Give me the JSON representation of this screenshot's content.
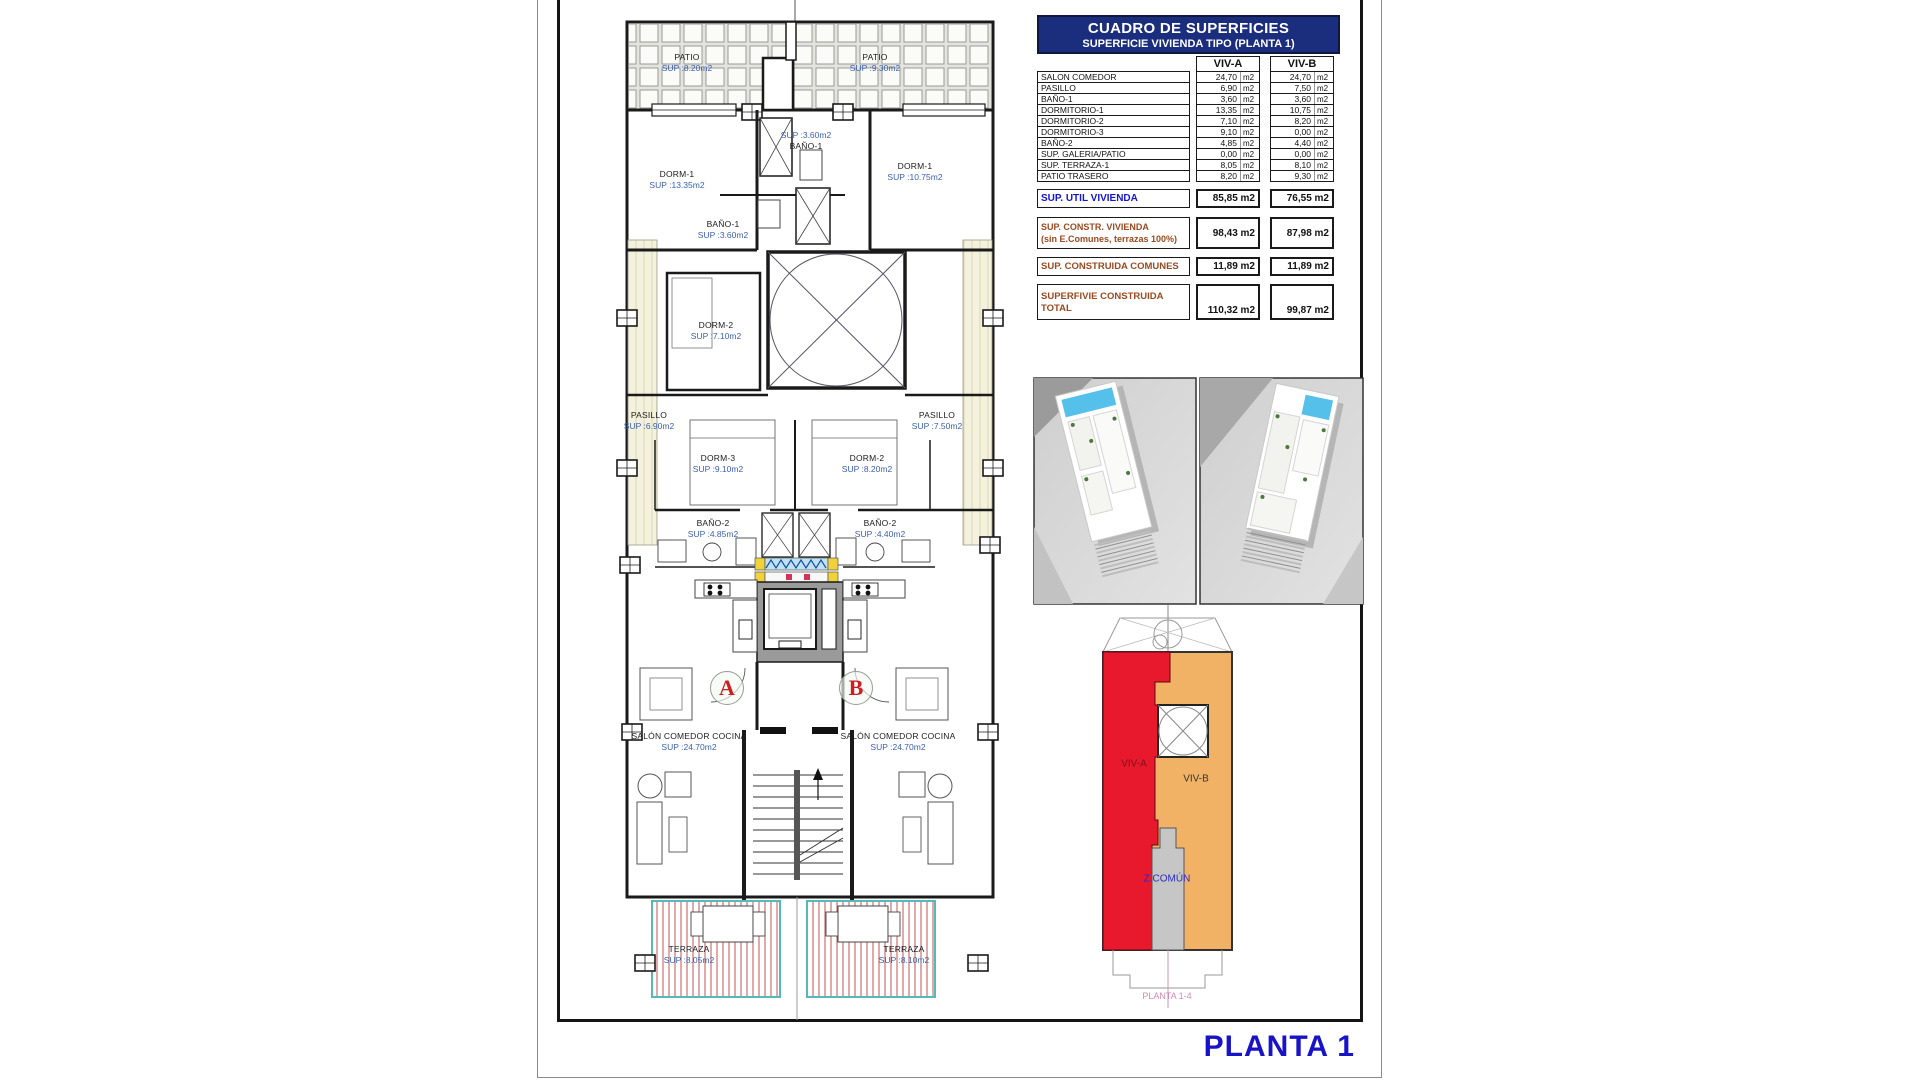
{
  "page": {
    "planta_title": "PLANTA 1"
  },
  "surface_table": {
    "title": "CUADRO DE SUPERFICIES",
    "subtitle": "SUPERFICIE VIVIENDA TIPO  (PLANTA 1)",
    "col_a": "VIV-A",
    "col_b": "VIV-B",
    "unit": "m2",
    "rows": [
      {
        "label": "SALON COMEDOR",
        "a": "24,70",
        "b": "24,70"
      },
      {
        "label": "PASILLO",
        "a": "6,90",
        "b": "7,50"
      },
      {
        "label": "BAÑO-1",
        "a": "3,60",
        "b": "3,60"
      },
      {
        "label": "DORMITORIO-1",
        "a": "13,35",
        "b": "10,75"
      },
      {
        "label": "DORMITORIO-2",
        "a": "7,10",
        "b": "8,20"
      },
      {
        "label": "DORMITORIO-3",
        "a": "9,10",
        "b": "0,00"
      },
      {
        "label": "BAÑO-2",
        "a": "4,85",
        "b": "4,40"
      },
      {
        "label": "SUP. GALERIA/PATIO",
        "a": "0,00",
        "b": "0,00"
      },
      {
        "label": "SUP. TERRAZA-1",
        "a": "8,05",
        "b": "8,10"
      },
      {
        "label": "PATIO TRASERO",
        "a": "8,20",
        "b": "9,30"
      }
    ],
    "util": {
      "label": "SUP. UTIL VIVIENDA",
      "a": "85,85 m2",
      "b": "76,55 m2"
    },
    "constr": {
      "label1": "SUP. CONSTR. VIVIENDA",
      "label2": "(sin E.Comunes, terrazas 100%)",
      "a": "98,43 m2",
      "b": "87,98 m2"
    },
    "comunes": {
      "label": "SUP. CONSTRUIDA COMUNES",
      "a": "11,89 m2",
      "b": "11,89 m2"
    },
    "total": {
      "label1": "SUPERFIVIE CONSTRUIDA",
      "label2": "TOTAL",
      "a": "110,32 m2",
      "b": "99,87 m2"
    }
  },
  "floor_plan": {
    "unit_a": "A",
    "unit_b": "B",
    "rooms": [
      {
        "name": "PATIO",
        "sup": "SUP :8.20m2"
      },
      {
        "name": "PATIO",
        "sup": "SUP :9.30m2"
      },
      {
        "name": "DORM-1",
        "sup": "SUP :13.35m2"
      },
      {
        "name": "BAÑO-1",
        "sup": "SUP :3.60m2"
      },
      {
        "name": "DORM-1",
        "sup": "SUP :10.75m2"
      },
      {
        "name": "BAÑO-1",
        "sup": "SUP :3.60m2"
      },
      {
        "name": "DORM-2",
        "sup": "SUP :7.10m2"
      },
      {
        "name": "PASILLO",
        "sup": "SUP :6.90m2"
      },
      {
        "name": "PASILLO",
        "sup": "SUP :7.50m2"
      },
      {
        "name": "DORM-3",
        "sup": "SUP :9.10m2"
      },
      {
        "name": "DORM-2",
        "sup": "SUP :8.20m2"
      },
      {
        "name": "BAÑO-2",
        "sup": "SUP :4.85m2"
      },
      {
        "name": "BAÑO-2",
        "sup": "SUP :4.40m2"
      },
      {
        "name": "SALÓN COMEDOR COCINA",
        "sup": "SUP :24.70m2"
      },
      {
        "name": "SALÓN COMEDOR COCINA",
        "sup": "SUP :24.70m2"
      },
      {
        "name": "TERRAZA",
        "sup": "SUP :8.05m2"
      },
      {
        "name": "TERRAZA",
        "sup": "SUP :8.10m2"
      }
    ]
  },
  "key_plan": {
    "viv_a": "VIV-A",
    "viv_b": "VIV-B",
    "comun": "Z.COMÚN",
    "caption": "PLANTA 1-4",
    "colors": {
      "viv_a": "#e8182d",
      "viv_b": "#f2b266",
      "comun": "#c6c6c6"
    }
  },
  "colors": {
    "table_header_navy": "#1b2d7d",
    "totals_blue": "#1515cc",
    "totals_brown": "#9a4a20",
    "planta_title_blue": "#1812c8",
    "plan_sup_blue": "#3a5fb0",
    "unit_letter_red": "#cc2020"
  }
}
